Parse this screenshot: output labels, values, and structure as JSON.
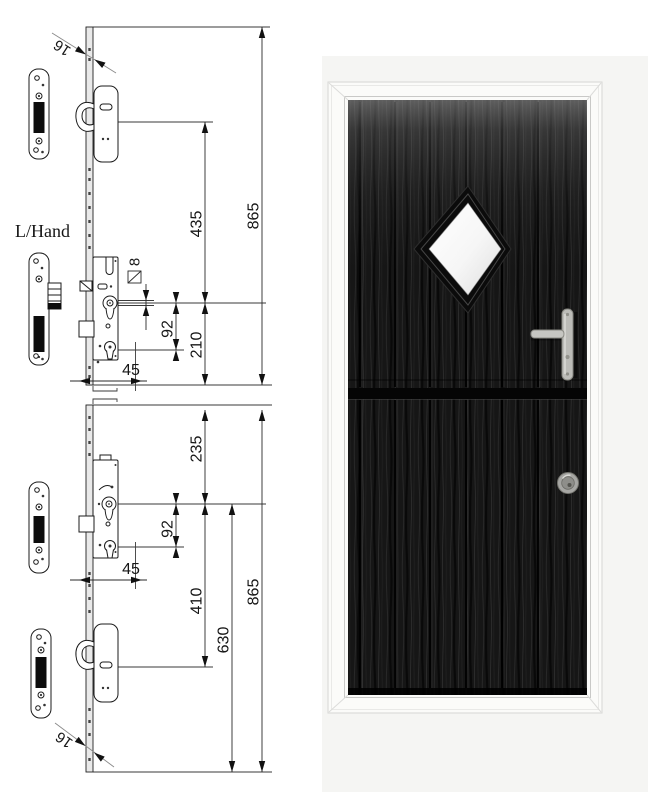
{
  "page": {
    "background": "#ffffff"
  },
  "diagram": {
    "hand_label": "L/Hand",
    "dimensions": {
      "faceplate_width_top": "16",
      "hook_to_spindle_upper": "435",
      "total_length_upper": "865",
      "spindle_square": "8",
      "spindle_to_cylinder_upper": "92",
      "spindle_to_bottom_upper": "210",
      "backset_upper": "45",
      "top_to_spindle_lower": "235",
      "spindle_to_cylinder_lower": "92",
      "backset_lower": "45",
      "spindle_to_hook_lower": "410",
      "spindle_to_bottom_lower": "630",
      "total_length_lower": "865",
      "faceplate_width_bottom": "16"
    },
    "colors": {
      "line": "#2a2a2a",
      "arrow": "#111111",
      "slot": "#0c0c0c",
      "plate": "#ffffff",
      "faceplate": "#e9e9e9"
    }
  },
  "door": {
    "colors": {
      "backdrop": "#f5f5f3",
      "frame": "#fbfbf9",
      "frame_edge": "#d6d6d4",
      "leaf": "#151515",
      "glass": "#fdfdfd",
      "hardware": "#bcbcb8"
    }
  }
}
